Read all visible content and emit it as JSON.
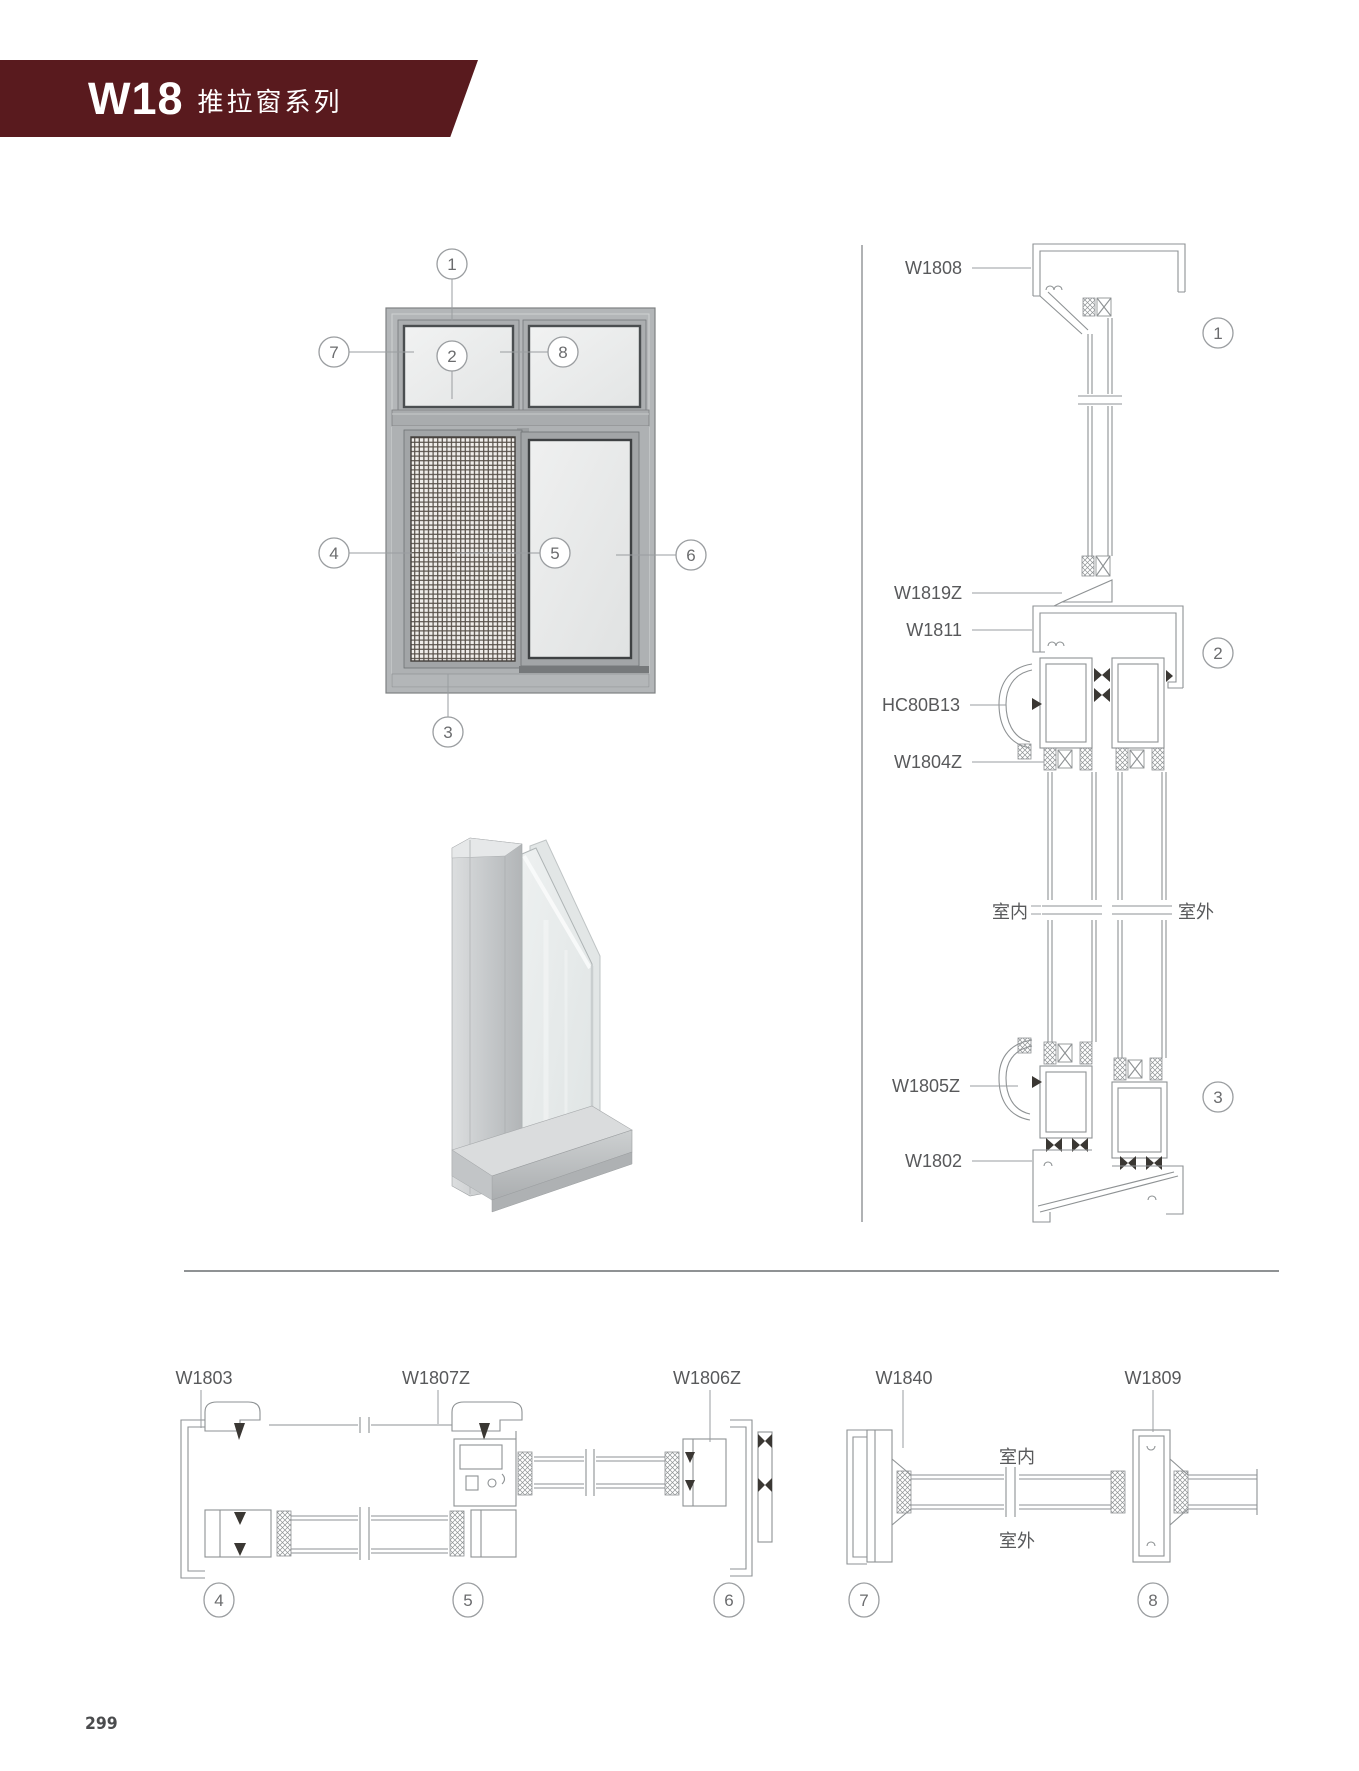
{
  "banner": {
    "model": "W18",
    "series": "推拉窗系列"
  },
  "colors": {
    "banner_bg": "#591A1E",
    "drawing_line": "#8E9294",
    "label_text": "#58595B"
  },
  "front_view": {
    "callouts": [
      "1",
      "2",
      "3",
      "4",
      "5",
      "6",
      "7",
      "8"
    ]
  },
  "vertical_section": {
    "labels": [
      "W1808",
      "W1819Z",
      "W1811",
      "HC80B13",
      "W1804Z",
      "W1805Z",
      "W1802"
    ],
    "interior_label": "室内",
    "exterior_label": "室外",
    "callouts": [
      "1",
      "2",
      "3"
    ]
  },
  "horizontal_sections": {
    "labels": [
      "W1803",
      "W1807Z",
      "W1806Z",
      "W1840",
      "W1809"
    ],
    "interior_label": "室内",
    "exterior_label": "室外",
    "callouts": [
      "4",
      "5",
      "6",
      "7",
      "8"
    ]
  },
  "footer": {
    "page_number": "299"
  }
}
